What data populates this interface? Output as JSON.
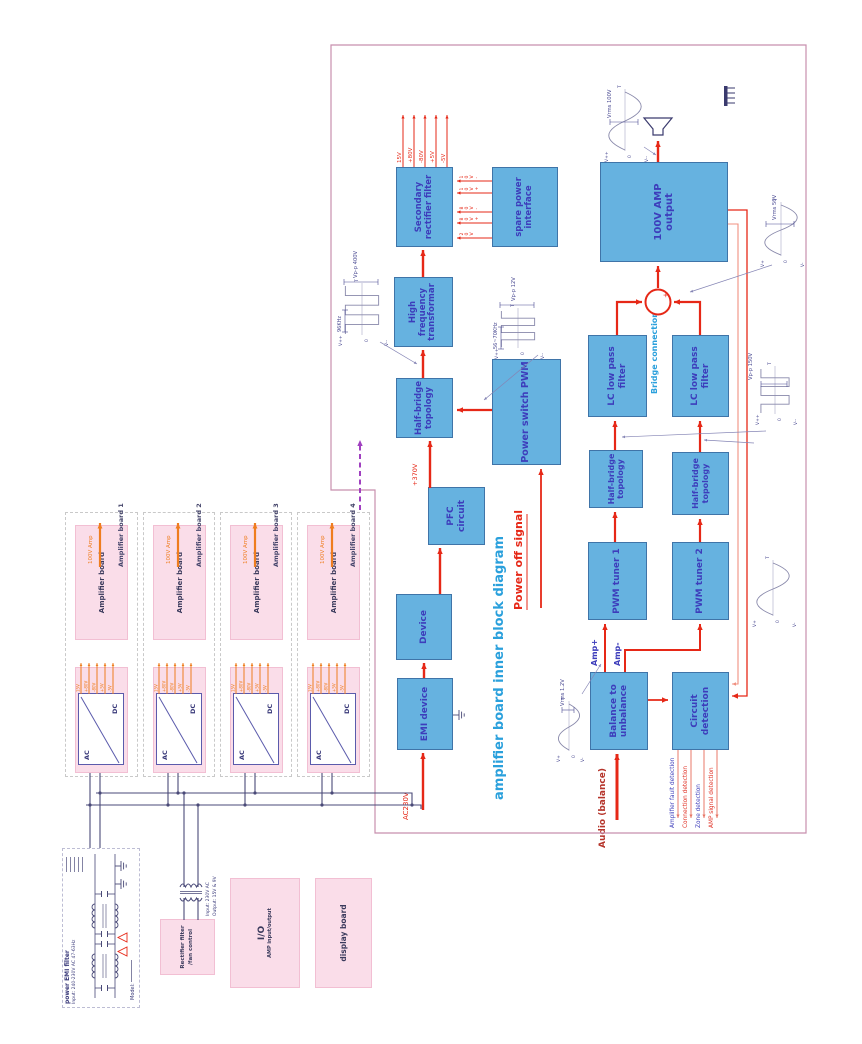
{
  "diagram": {
    "title": "amplifier board inner block diagram",
    "power_off": "Power off signal",
    "audio_in": "Audio (balance)",
    "ac_in": "AC230V",
    "v370": "+370V",
    "amp_p": "Amp+",
    "amp_m": "Amp-",
    "bridge": "Bridge connection"
  },
  "blocks": {
    "emi": "EMI device",
    "device": "Device",
    "pfc": "PFC circuit",
    "hb": "Half-bridge topology",
    "hft": "High frequency transformar",
    "sec": "Secondary rectifier filter",
    "spare": "spare power interface",
    "pwm": "Power switch PWM",
    "bal": "Balance to unbalance",
    "cdet": "Circuit detection",
    "pwm1": "PWM tuner 1",
    "pwm2": "PWM tuner 2",
    "hb1": "Half-bridge topology",
    "hb2": "Half-bridge topology",
    "lc1": "LC low pass filter",
    "lc2": "LC low pass filter",
    "ampout": "100V AMP output"
  },
  "rails_out": [
    "15V",
    "+80V",
    "-80V",
    "+5V",
    "-5V"
  ],
  "spare_rails": [
    "20V",
    "80V+",
    "80V-",
    "10V+",
    "10V-"
  ],
  "detections": [
    {
      "label": "Amplifier fault detection",
      "color": "#3d3dbb"
    },
    {
      "label": "Connection detection",
      "color": "#e03024"
    },
    {
      "label": "Zone detection",
      "color": "#3d3dbb"
    },
    {
      "label": "AMP signal detection",
      "color": "#e03024"
    }
  ],
  "groups": {
    "labels": [
      "Amplifier board 1",
      "Amplifier board 2",
      "Amplifier board 3",
      "Amplifier board 4"
    ],
    "amp": "Amplifier board",
    "power": "power board",
    "ac": "AC",
    "dc": "DC",
    "out": "100V Amp",
    "rails": [
      "15V",
      "+80V",
      "-80V",
      "+5V",
      "-5V"
    ]
  },
  "bottom_left": {
    "emi_title": "power EMI filter",
    "emi_input": "Input: 240-230V AC 47-63Hz",
    "emi_model": "Model:",
    "rect_line1": "Rectifier filter",
    "rect_line2": "/fan control",
    "trans_in": "Input: 230V AC",
    "trans_out": "Output: 15V & 9V",
    "io_title": "I/O",
    "io_sub": "AMP input/output",
    "display": "display board"
  },
  "waveforms": {
    "hft": {
      "freq": "96KHz",
      "volt": "Vp-p 400V",
      "vp": "V++",
      "vm": "V--",
      "zero": "0",
      "t": "T"
    },
    "pwm": {
      "freq": "56~70KHz",
      "volt": "Vp-p 12V",
      "vp": "V++",
      "vm": "V--",
      "zero": "0",
      "t": "T"
    },
    "audio": {
      "volt": "Vrms 1.2V",
      "vp": "V+",
      "vm": "V-",
      "zero": "0",
      "t": "T"
    },
    "tuner": {
      "vp": "V+",
      "vm": "V-",
      "zero": "0",
      "t": "T"
    },
    "bridge_sq": {
      "volt": "Vp-p 150V",
      "vp": "V++",
      "vm": "V--",
      "zero": "0",
      "t": "T"
    },
    "out50": {
      "volt": "Vrms 50V",
      "vp": "V+",
      "vm": "V-",
      "zero": "0",
      "t": "T"
    },
    "out100": {
      "volt": "Vrms 100V",
      "vp": "V++",
      "vm": "V--",
      "zero": "0",
      "t": "T"
    }
  },
  "colors": {
    "red": "#e62817",
    "dark_red": "#b5342a",
    "orange": "#ef7d1f",
    "blue_fill": "#66b2e0",
    "blue_border": "#3f74a8",
    "block_text": "#3d3dbb",
    "pink_fill": "#fadde9",
    "pink_border": "#f2bfd3",
    "wire": "#4a4a78",
    "box_border": "#c88fae",
    "title_blue": "#2aa0dc",
    "purple": "#a040c0",
    "salmon": "#f09080",
    "wave": "#8888aa",
    "wave_text": "#4a4a92"
  }
}
